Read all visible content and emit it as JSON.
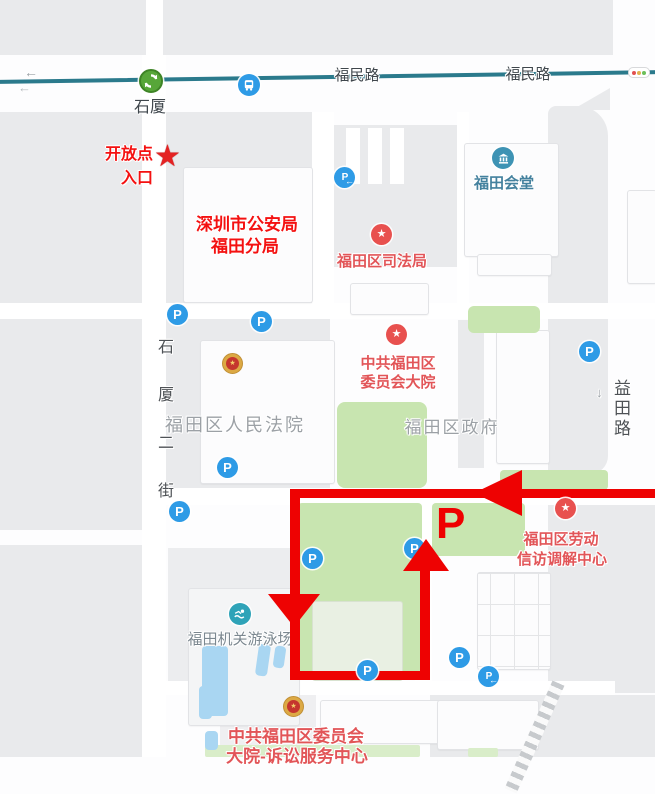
{
  "map": {
    "transit_line": {
      "name_label_1": "福民路",
      "name_label_2": "福民路",
      "station_name": "石厦"
    },
    "streets": {
      "shixia_2nd": "石厦二街",
      "yitian": "益田路"
    },
    "pois": {
      "police_bureau": {
        "line1": "深圳市公安局",
        "line2": "福田分局"
      },
      "justice_bureau": {
        "label": "福田区司法局"
      },
      "futian_hall": {
        "label": "福田会堂"
      },
      "committee_compound": {
        "line1": "中共福田区",
        "line2": "委员会大院"
      },
      "people_court": {
        "label": "福田区人民法院"
      },
      "district_government": {
        "label": "福田区政府"
      },
      "swimming_pool": {
        "label": "福田机关游泳场"
      },
      "labor_center": {
        "line1": "福田区劳动",
        "line2": "信访调解中心"
      },
      "litigation_center": {
        "line1": "中共福田区委员会",
        "line2": "大院-诉讼服务中心"
      }
    },
    "annotations": {
      "entrance": {
        "line1": "开放点",
        "line2": "入口"
      },
      "parking_letter": "P"
    },
    "glyphs": {
      "parking": "P",
      "left_arrow": "←",
      "down_arrow": "↓",
      "star": "★"
    },
    "colors": {
      "route_red": "#EE0202",
      "annotation_red": "#F41111",
      "poi_red": "#E25558",
      "poi_icon_red": "#E8514F",
      "lawn_green": "#C8E5B0",
      "water_blue": "#A9D6F2",
      "parking_blue": "#2E9BE6",
      "metro_green": "#57A639",
      "hall_teal": "#3E93B4",
      "swim_teal": "#2FA3B8",
      "metro_line_teal": "#2B7A8C",
      "gray_label": "#9CA1A6",
      "street_label": "#4E5256"
    }
  }
}
